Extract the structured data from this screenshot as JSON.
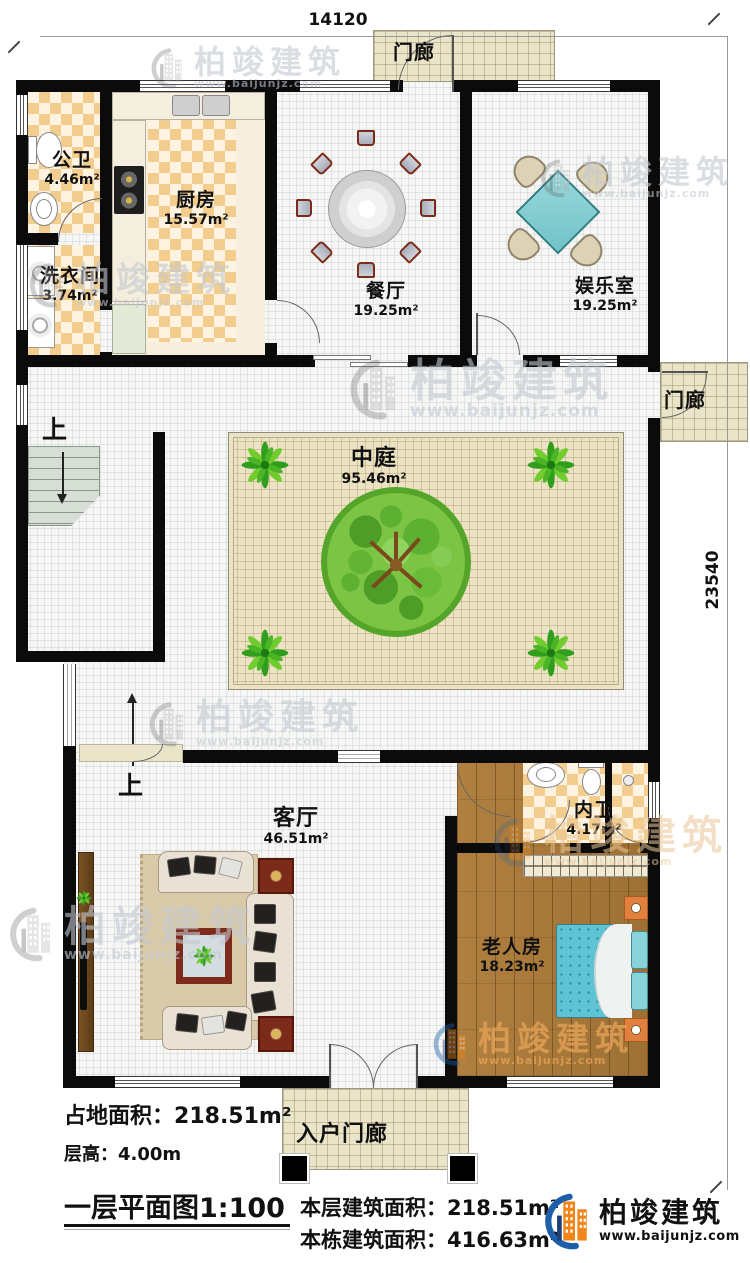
{
  "plan": {
    "dim_top": "14120",
    "dim_right": "23540",
    "up_label": "上",
    "porch_top": "门廊",
    "porch_right": "门廊",
    "entry_porch": "入户门廊",
    "rooms": {
      "public_bath": {
        "name": "公卫",
        "area": "4.46m²"
      },
      "laundry": {
        "name": "洗衣间",
        "area": "3.74m²"
      },
      "kitchen": {
        "name": "厨房",
        "area": "15.57m²"
      },
      "dining": {
        "name": "餐厅",
        "area": "19.25m²"
      },
      "recreation": {
        "name": "娱乐室",
        "area": "19.25m²"
      },
      "atrium": {
        "name": "中庭",
        "area": "95.46m²"
      },
      "living": {
        "name": "客厅",
        "area": "46.51m²"
      },
      "inner_bath": {
        "name": "内卫",
        "area": "4.17m²"
      },
      "elder_room": {
        "name": "老人房",
        "area": "18.23m²"
      }
    }
  },
  "footer": {
    "land_area_label": "占地面积：",
    "land_area_value": "218.51m²",
    "floor_height_label": "层高：",
    "floor_height_value": "4.00m",
    "title": "一层平面图1:100",
    "floor_area_label": "本层建筑面积：",
    "floor_area_value": "218.51m²",
    "total_area_label": "本栋建筑面积：",
    "total_area_value": "416.63m²"
  },
  "brand": {
    "name": "柏竣建筑",
    "url": "www.baijunjz.com"
  },
  "watermark": {
    "name": "柏竣建筑",
    "url": "www.baijunjz.com"
  }
}
